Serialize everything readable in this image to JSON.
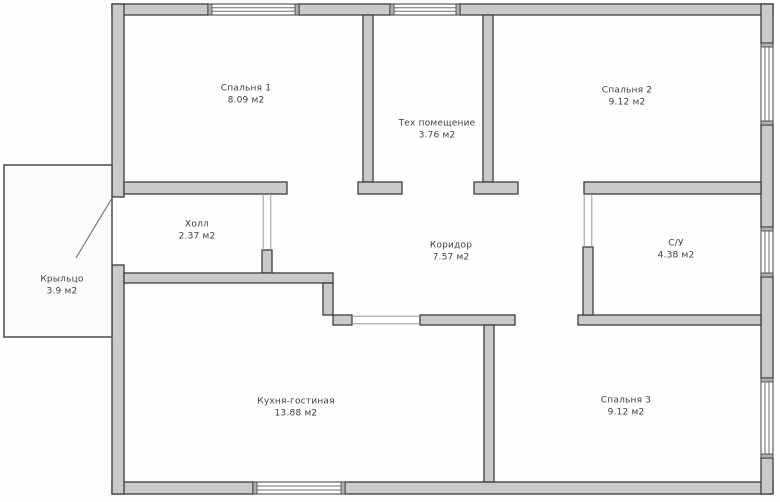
{
  "plan": {
    "rooms": [
      {
        "id": "bedroom-1",
        "name": "Спальня 1",
        "area": "8.09 м2"
      },
      {
        "id": "tech-room",
        "name": "Тех помещение",
        "area": "3.76 м2"
      },
      {
        "id": "bedroom-2",
        "name": "Спальня 2",
        "area": "9.12 м2"
      },
      {
        "id": "hall",
        "name": "Холл",
        "area": "2.37 м2"
      },
      {
        "id": "corridor",
        "name": "Коридор",
        "area": "7.57 м2"
      },
      {
        "id": "bathroom",
        "name": "С/У",
        "area": "4.38 м2"
      },
      {
        "id": "porch",
        "name": "Крыльцо",
        "area": "3.9 м2"
      },
      {
        "id": "kitchen-living",
        "name": "Кухня-гостиная",
        "area": "13.88 м2"
      },
      {
        "id": "bedroom-3",
        "name": "Спальня 3",
        "area": "9.12 м2"
      }
    ],
    "colors": {
      "wall_fill": "#cacaca",
      "wall_outline": "#3c3c3c",
      "window_fill": "#ffffff",
      "background": "#fefefe",
      "text": "#3e3e3e"
    }
  }
}
